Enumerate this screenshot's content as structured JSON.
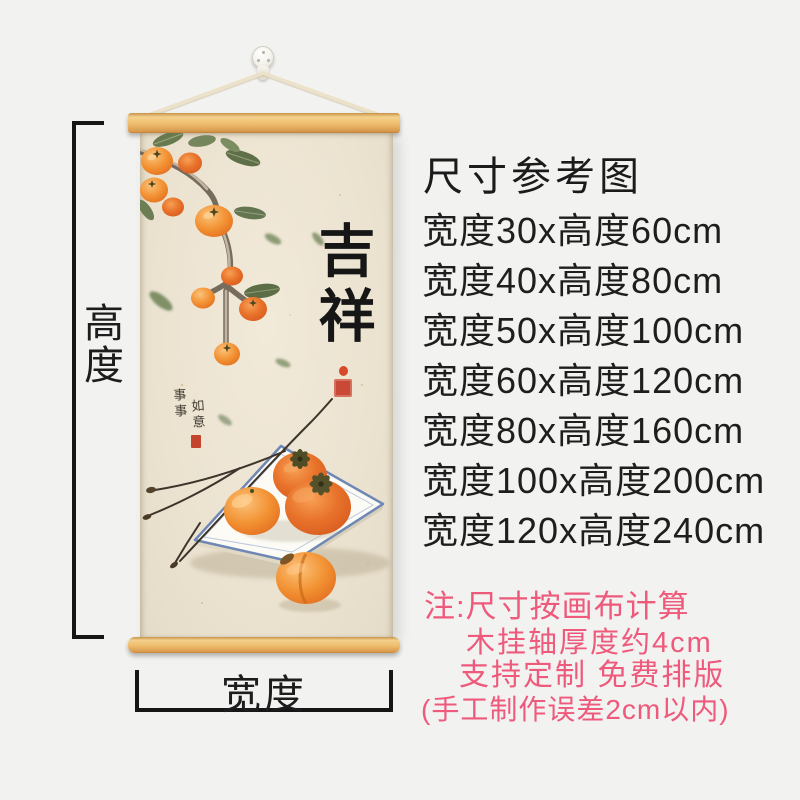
{
  "page": {
    "background_color": "#f2f2f0"
  },
  "scroll_product": {
    "calligraphy_text": "吉祥",
    "inscription_col1": "事事",
    "inscription_col2": "如意",
    "artwork_subject": "persimmon-branch-and-plate-illustration",
    "wood_rod_color": "#eebd6e",
    "canvas_color": "#ebe2d0",
    "seal_color": "#c94836"
  },
  "measurements": {
    "height_label": "高度",
    "width_label": "宽度",
    "line_color": "#161616"
  },
  "size_chart": {
    "title": "尺寸参考图",
    "sizes": [
      "宽度30x高度60cm",
      "宽度40x高度80cm",
      "宽度50x高度100cm",
      "宽度60x高度120cm",
      "宽度80x高度160cm",
      "宽度100x高度200cm",
      "宽度120x高度240cm"
    ],
    "notes": [
      "注:尺寸按画布计算",
      "木挂轴厚度约4cm",
      "支持定制 免费排版",
      "(手工制作误差2cm以内)"
    ],
    "text_color": "#1e1e1e",
    "note_color": "#ee5a7c"
  }
}
